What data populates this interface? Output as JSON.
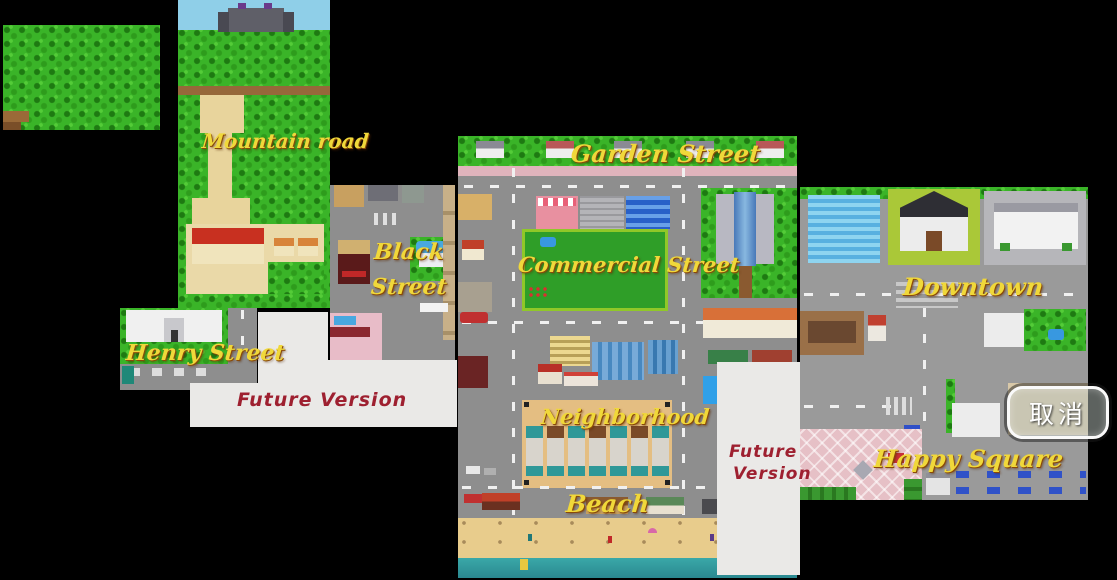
{
  "screen": {
    "width": 1117,
    "height": 580,
    "background": "#000000"
  },
  "labels": {
    "mountain_road": "Mountain road",
    "black": "Black",
    "street": "Street",
    "henry_street": "Henry Street",
    "garden_street": "Garden Street",
    "commercial_street": "Commercial Street",
    "neighborhood": "Neighborhood",
    "beach": "Beach",
    "downtown": "Downtown",
    "happy_square": "Happy Square"
  },
  "future_version": {
    "left_text": "Future Version",
    "right_line1": "Future",
    "right_line2": "Version"
  },
  "cancel_button": {
    "label": "取消"
  },
  "regions": [
    "forest",
    "mountain-road",
    "black-street",
    "henry-street",
    "garden-street",
    "commercial-street",
    "neighborhood",
    "beach",
    "downtown",
    "happy-square"
  ],
  "colors": {
    "label_yellow": "#f0d83a",
    "label_shadow": "#8a4a08",
    "future_text_red": "#9e2030",
    "future_panel_bg": "#eae9e7",
    "grass_green": "#3ab428",
    "road_gray": "#8e8e8e",
    "sand_tan": "#e8cc8c",
    "water_teal": "#2fa0a0",
    "sky_blue": "#8fcfe8",
    "sidewalk_pink": "#e0b4bc",
    "plaza_pink": "#e6c0c6",
    "cancel_border": "#fafafa",
    "cancel_text": "#ffffff"
  }
}
